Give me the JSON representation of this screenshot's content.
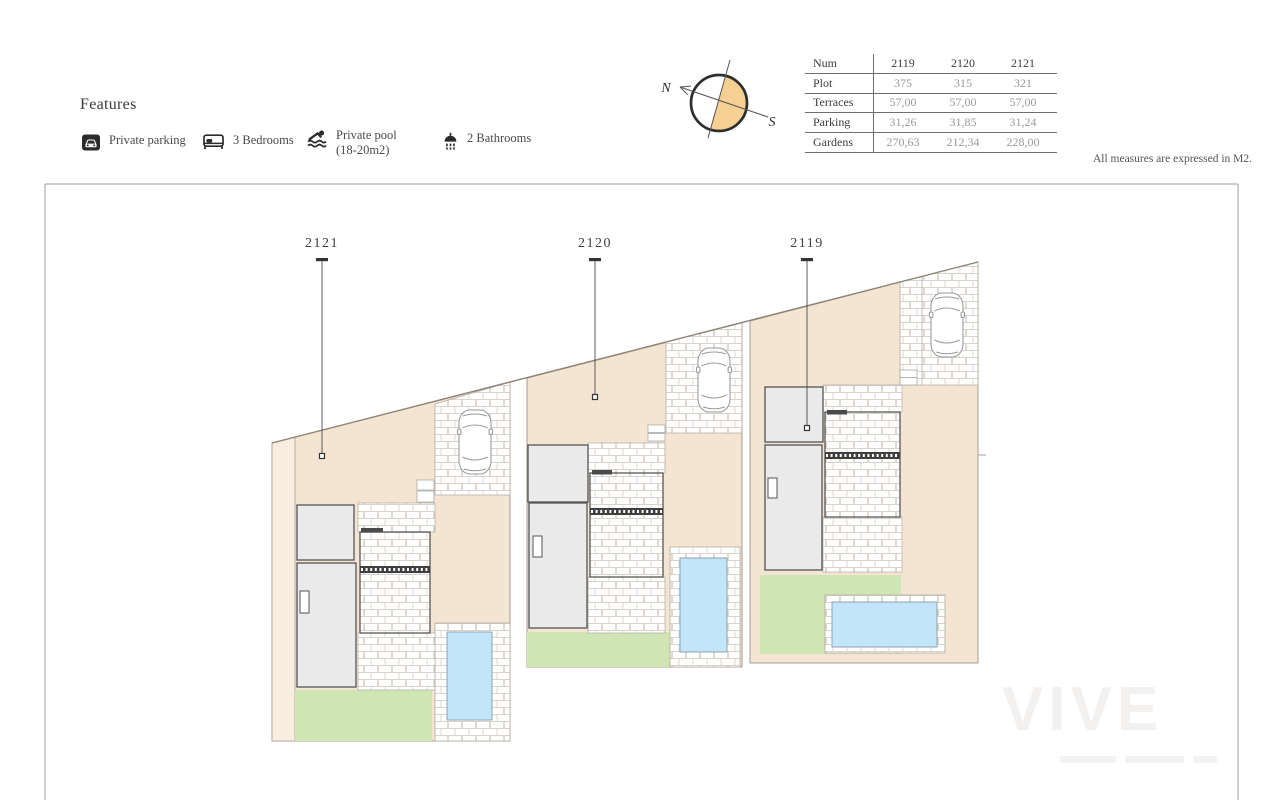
{
  "features": {
    "title": "Features",
    "items": [
      {
        "icon": "parking-icon",
        "line1": "Private parking",
        "line2": ""
      },
      {
        "icon": "bed-icon",
        "line1": "3 Bedrooms",
        "line2": ""
      },
      {
        "icon": "pool-icon",
        "line1": "Private pool",
        "line2": "(18-20m2)"
      },
      {
        "icon": "bathroom-icon",
        "line1": "2 Bathrooms",
        "line2": ""
      }
    ]
  },
  "measure_note": "All measures are expressed in M2.",
  "compass": {
    "north": "N",
    "south": "S"
  },
  "spec_table": {
    "header": {
      "label": "Num",
      "values": [
        "2119",
        "2120",
        "2121"
      ]
    },
    "rows": [
      {
        "label": "Plot",
        "values": [
          "375",
          "315",
          "321"
        ]
      },
      {
        "label": "Terraces",
        "values": [
          "57,00",
          "57,00",
          "57,00"
        ]
      },
      {
        "label": "Parking",
        "values": [
          "31,26",
          "31,85",
          "31,24"
        ]
      },
      {
        "label": "Gardens",
        "values": [
          "270,63",
          "212,34",
          "228,00"
        ]
      }
    ]
  },
  "plan": {
    "plot_labels": [
      "2121",
      "2120",
      "2119"
    ]
  },
  "watermark": "VIVE",
  "colors": {
    "plot_fill": "#f4e4d2",
    "plot_fill_light": "#f8ede0",
    "garden": "#cfe5b3",
    "pool": "#c2e5f9",
    "building": "#eaeaea",
    "compass_fill": "#f6cf92"
  }
}
